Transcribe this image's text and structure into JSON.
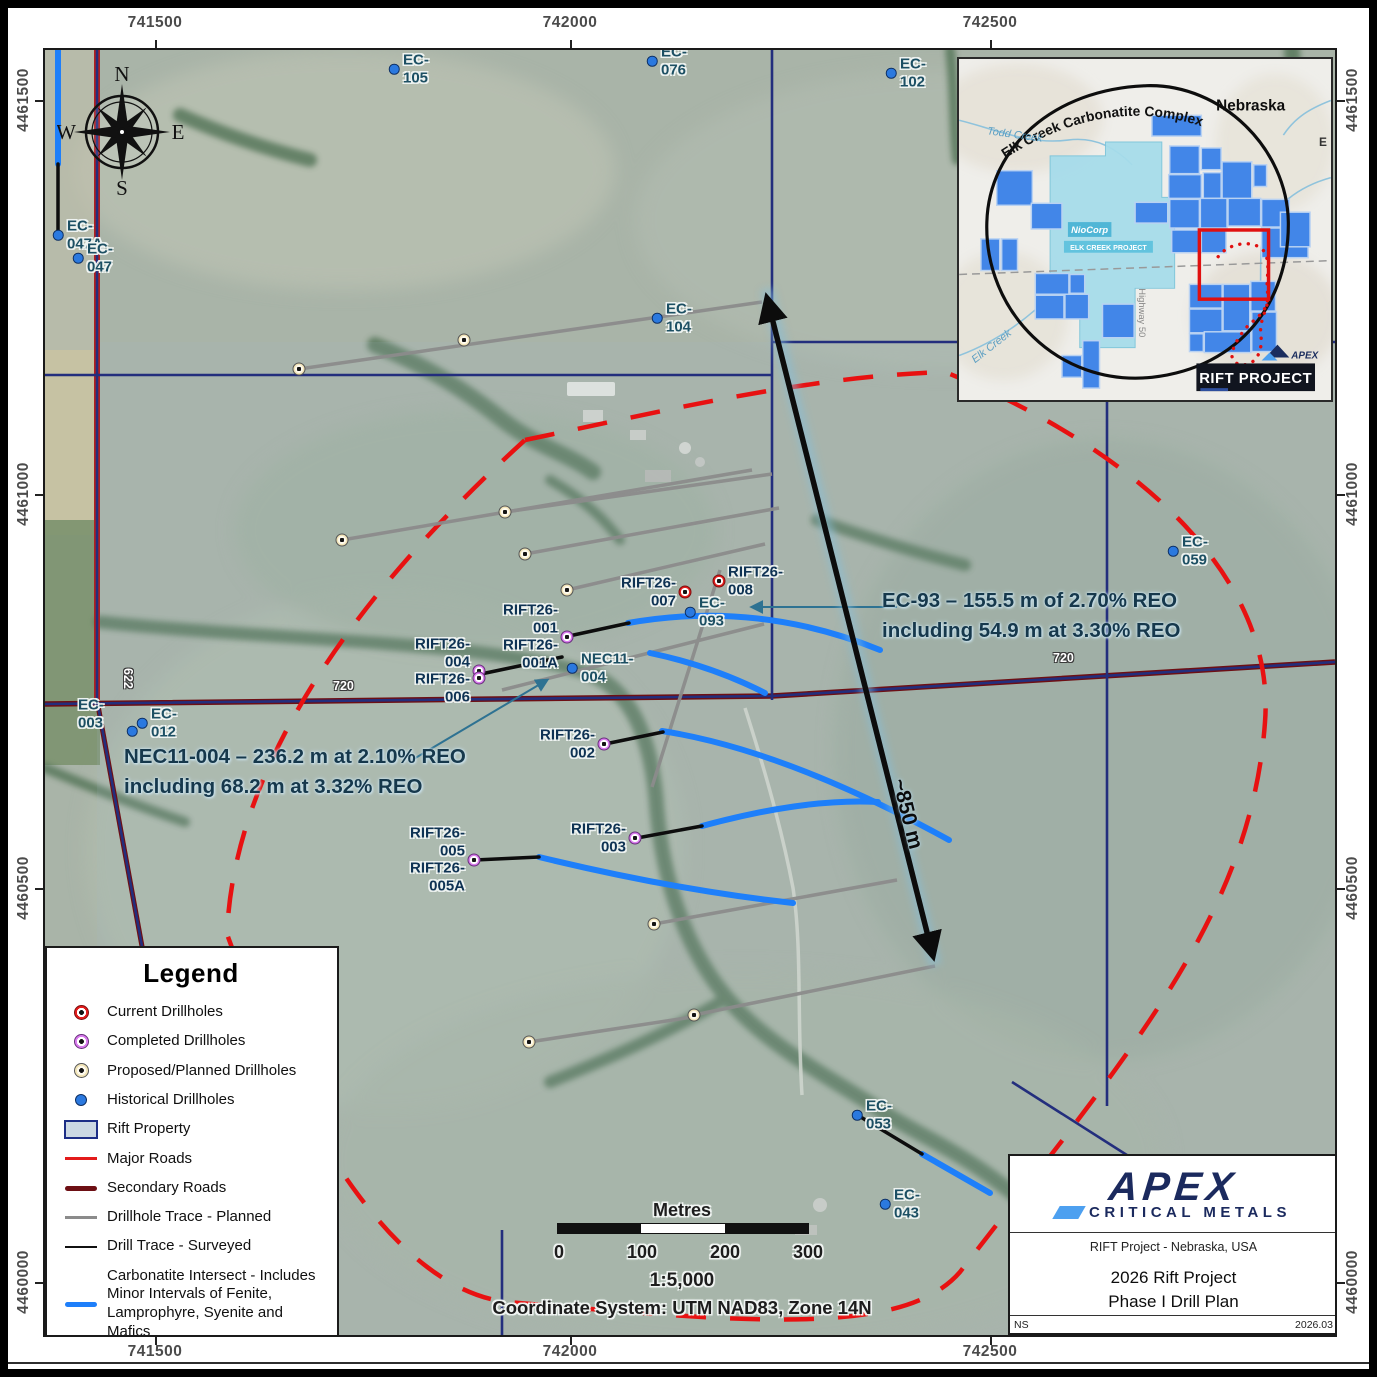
{
  "map": {
    "axes": {
      "top": [
        "741500",
        "742000",
        "742500"
      ],
      "bottom": [
        "741500",
        "742000",
        "742500"
      ],
      "left": [
        "4461500",
        "4461000",
        "4460500",
        "4460000"
      ],
      "right": [
        "4461500",
        "4461000",
        "4460500",
        "4460000"
      ]
    },
    "compass": {
      "n": "N",
      "e": "E",
      "s": "S",
      "w": "W"
    },
    "road_labels": [
      "720",
      "720",
      "622"
    ],
    "annotations": {
      "ec93_line1": "EC-93 – 155.5 m of 2.70% REO",
      "ec93_line2": "including 54.9 m at 3.30% REO",
      "nec11_line1": "NEC11-004 – 236.2 m at 2.10% REO",
      "nec11_line2": "including 68.2 m at 3.32% REO",
      "distance": "~850 m"
    },
    "scalebar": {
      "unit_label": "Metres",
      "ticks": [
        "0",
        "100",
        "200",
        "300"
      ],
      "ratio": "1:5,000",
      "coordinate_system": "Coordinate System: UTM NAD83, Zone 14N"
    },
    "markers": [
      {
        "label": "EC-105",
        "type": "historical",
        "x": 349,
        "y": 19,
        "side": "right"
      },
      {
        "label": "EC-076",
        "type": "historical",
        "x": 607,
        "y": 11,
        "side": "right"
      },
      {
        "label": "EC-102",
        "type": "historical",
        "x": 846,
        "y": 23,
        "side": "right"
      },
      {
        "label": "EC-104",
        "type": "historical",
        "x": 612,
        "y": 268,
        "side": "right"
      },
      {
        "label": "EC-047A",
        "type": "historical",
        "x": 13,
        "y": 185,
        "side": "right"
      },
      {
        "label": "EC-047",
        "type": "historical",
        "x": 33,
        "y": 208,
        "side": "right"
      },
      {
        "label": "EC-059",
        "type": "historical",
        "x": 1128,
        "y": 501,
        "side": "right"
      },
      {
        "label": "EC-093",
        "type": "historical",
        "x": 645,
        "y": 562,
        "side": "right"
      },
      {
        "label": "NEC11-004",
        "type": "historical",
        "x": 527,
        "y": 618,
        "side": "right"
      },
      {
        "label": "EC-012",
        "type": "historical",
        "x": 97,
        "y": 673,
        "side": "right"
      },
      {
        "label": null,
        "type": "historical",
        "x": 87,
        "y": 681
      },
      {
        "label": "EC-003",
        "type": "label-only",
        "x": 24,
        "y": 664,
        "side": "right"
      },
      {
        "label": "EC-053",
        "type": "historical",
        "x": 812,
        "y": 1065,
        "side": "right"
      },
      {
        "label": "EC-043",
        "type": "historical",
        "x": 840,
        "y": 1154,
        "side": "right"
      },
      {
        "label": "RIFT26-007",
        "type": "current",
        "x": 640,
        "y": 542,
        "side": "left"
      },
      {
        "label": "RIFT26-008",
        "type": "current",
        "x": 674,
        "y": 531,
        "side": "right"
      },
      {
        "label": "RIFT26-001\nRIFT26-001A",
        "type": "completed",
        "x": 522,
        "y": 587,
        "side": "left"
      },
      {
        "label": "RIFT26-004\nRIFT26-006",
        "type": "completed",
        "x": 434,
        "y": 621,
        "side": "left",
        "double": true
      },
      {
        "label": "RIFT26-002",
        "type": "completed",
        "x": 559,
        "y": 694,
        "side": "left"
      },
      {
        "label": "RIFT26-003",
        "type": "completed",
        "x": 590,
        "y": 788,
        "side": "left"
      },
      {
        "label": "RIFT26-005\nRIFT26-005A",
        "type": "completed",
        "x": 429,
        "y": 810,
        "side": "left"
      },
      {
        "label": null,
        "type": "proposed",
        "x": 419,
        "y": 290
      },
      {
        "label": null,
        "type": "proposed",
        "x": 254,
        "y": 319
      },
      {
        "label": null,
        "type": "proposed",
        "x": 297,
        "y": 490
      },
      {
        "label": null,
        "type": "proposed",
        "x": 460,
        "y": 462
      },
      {
        "label": null,
        "type": "proposed",
        "x": 480,
        "y": 504
      },
      {
        "label": null,
        "type": "proposed",
        "x": 522,
        "y": 540
      },
      {
        "label": null,
        "type": "proposed",
        "x": 609,
        "y": 874
      },
      {
        "label": null,
        "type": "proposed",
        "x": 649,
        "y": 965
      },
      {
        "label": null,
        "type": "proposed",
        "x": 484,
        "y": 992
      }
    ]
  },
  "legend": {
    "title": "Legend",
    "items": [
      {
        "label": "Current Drillholes",
        "type": "current"
      },
      {
        "label": "Completed Drillholes",
        "type": "completed"
      },
      {
        "label": "Proposed/Planned Drillholes",
        "type": "proposed"
      },
      {
        "label": "Historical Drillholes",
        "type": "historical"
      },
      {
        "label": "Rift Property",
        "type": "property"
      },
      {
        "label": "Major Roads",
        "type": "major-road"
      },
      {
        "label": "Secondary Roads",
        "type": "secondary-road"
      },
      {
        "label": "Drillhole Trace - Planned",
        "type": "planned-trace"
      },
      {
        "label": "Drill Trace - Surveyed",
        "type": "surveyed-trace"
      },
      {
        "label": "Carbonatite Intersect - Includes Minor Intervals of Fenite, Lamprophyre, Syenite and Mafics",
        "type": "carbonatite"
      },
      {
        "label": "Phase 1 Priority Target Area",
        "type": "target-area"
      }
    ]
  },
  "inset": {
    "complex_label": "Elk Creek Carbonatite Complex",
    "state_label": "Nebraska",
    "todd_creek": "Todd Creek",
    "elk_creek": "Elk Creek",
    "niocorp": "NioCorp",
    "niocorp_sub": "ELK CREEK PROJECT",
    "highway": "Highway 50",
    "project_label": "RIFT PROJECT",
    "mini_brand": "APEX",
    "edge_letter": "E"
  },
  "title_block": {
    "brand": "APEX",
    "brand_sub": "CRITICAL METALS",
    "subtitle": "RIFT Project - Nebraska, USA",
    "title_line1": "2026 Rift Project",
    "title_line2": "Phase I Drill Plan",
    "footer_left": "NS",
    "footer_right": "2026.03"
  },
  "colors": {
    "carbonatite_blue": "#1e7ffa",
    "major_road": "#e31b1b",
    "secondary_road": "#6d0f14",
    "planned_trace": "#8b8b8b",
    "surveyed_trace": "#111111",
    "target_area_red": "#e81111",
    "property_line_navy": "#232e7d",
    "current_red": "#e41d1d",
    "completed_violet": "#da7cee",
    "proposed_cream": "#f2e5b8",
    "historical_blue": "#2b79df"
  }
}
